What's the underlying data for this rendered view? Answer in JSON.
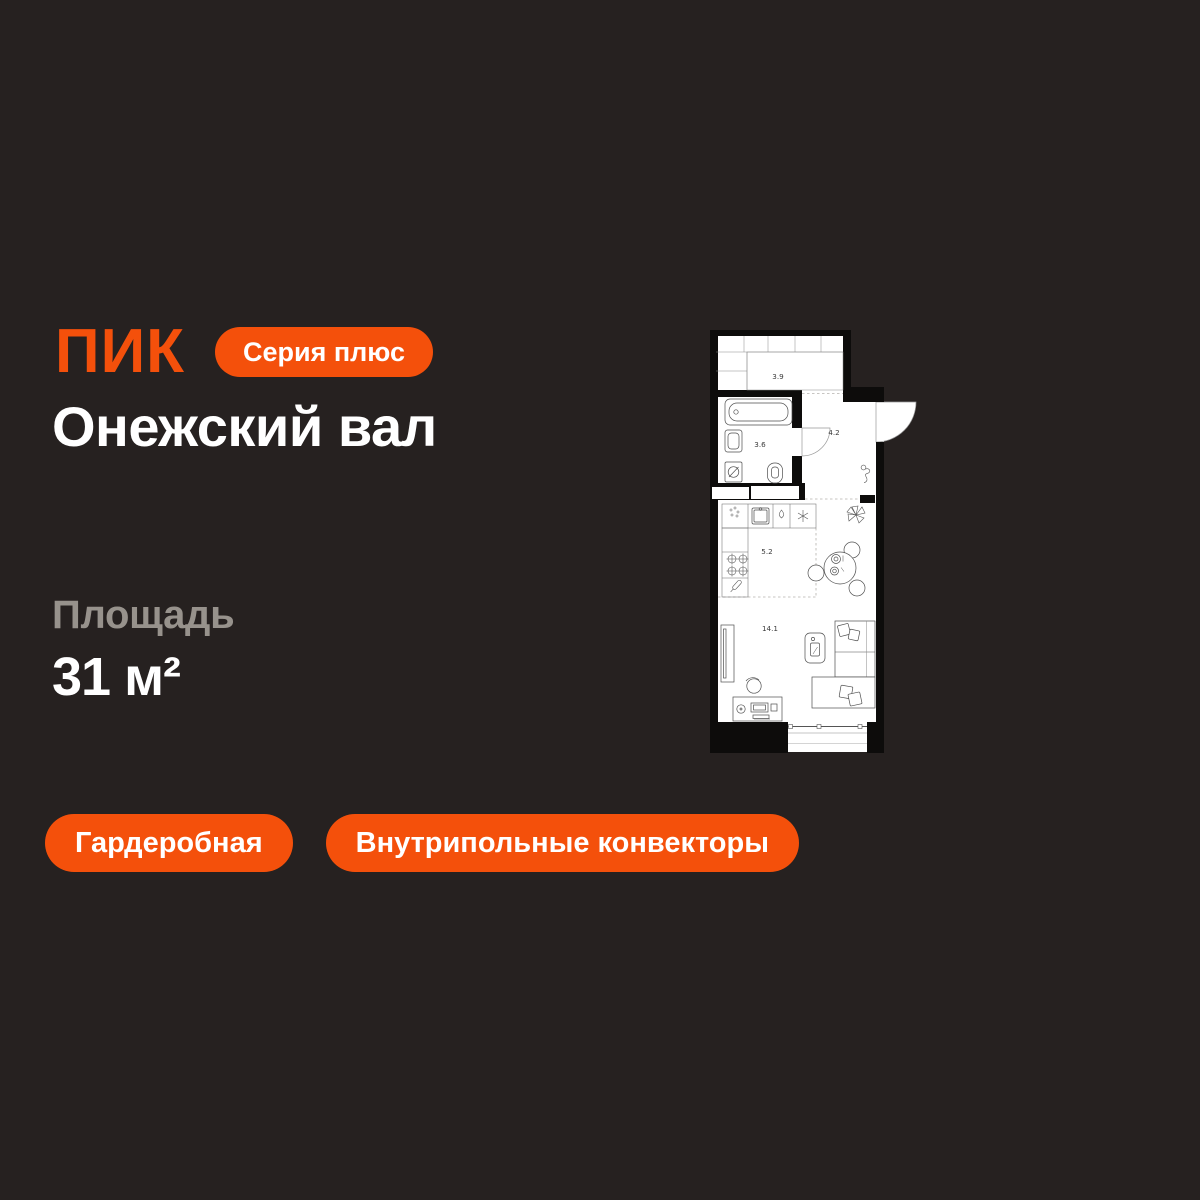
{
  "header": {
    "logo": "ПИК",
    "series_badge": "Серия плюс"
  },
  "project": {
    "title": "Онежский вал"
  },
  "area": {
    "label": "Площадь",
    "value": "31 м²"
  },
  "features": [
    "Гардеробная",
    "Внутрипольные конвекторы"
  ],
  "plan": {
    "rooms": {
      "storage": "3.9",
      "hallway": "4.2",
      "bathroom": "3.6",
      "kitchen": "5.2",
      "living": "14.1"
    }
  },
  "colors": {
    "background": "#262120",
    "accent_orange": "#F4500B",
    "title_white": "#FFFFFF",
    "label_gray": "#97928C",
    "plan_walls": "#0D0C0B",
    "plan_floor": "#FFFFFF"
  }
}
